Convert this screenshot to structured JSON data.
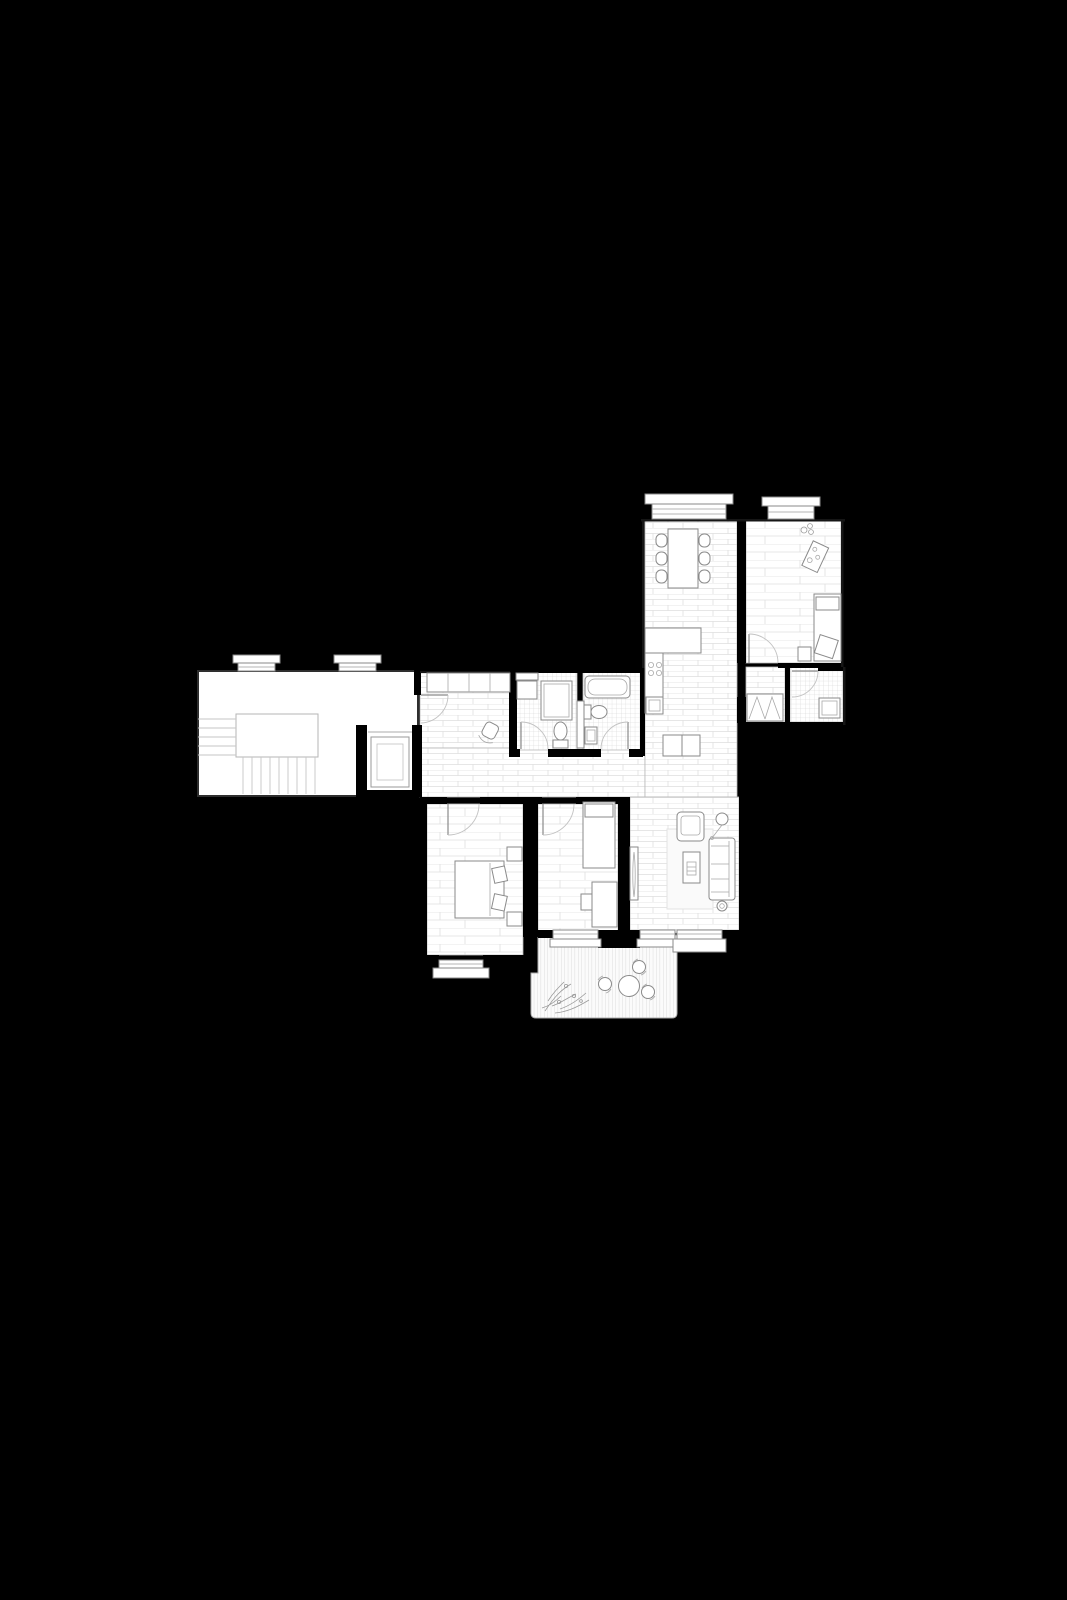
{
  "document": {
    "kind": "architectural floor plan",
    "orientation": "top-down",
    "visible_text": "none",
    "colors": {
      "background": "#000000",
      "floor_paper": "#ffffff",
      "interior_walls": "#000000",
      "furniture_line": "#8a8a8a",
      "floor_hatch_line": "#dcdcdc",
      "rug_fill": "#fafafa"
    }
  },
  "plan": {
    "rooms": [
      {
        "id": "stairwell",
        "name": "stairwell landing",
        "floor": "plain",
        "features": [
          "winder-staircase",
          "landing-void",
          "elevator-shaft"
        ],
        "windows": 2
      },
      {
        "id": "entry-hall",
        "name": "entry hall",
        "floor": "brick-tile",
        "furniture": [
          "built-in-wardrobe-4-sections",
          "stool"
        ]
      },
      {
        "id": "corridor",
        "name": "corridor",
        "floor": "brick-tile",
        "furniture": []
      },
      {
        "id": "bathroom-shower",
        "name": "shower bathroom",
        "floor": "fine-grid-tile",
        "furniture": [
          "washing-machine",
          "shelf",
          "shower-cabin",
          "toilet"
        ]
      },
      {
        "id": "bathroom-tub",
        "name": "bathtub bathroom",
        "floor": "fine-grid-tile",
        "furniture": [
          "bathtub",
          "toilet",
          "washbasin",
          "pocket-door"
        ]
      },
      {
        "id": "kitchen-dining",
        "name": "kitchen and dining room",
        "floor": "brick-tile",
        "furniture": [
          "dining-table",
          "six-chairs",
          "l-shaped-counter",
          "cooktop-4-burners",
          "oven",
          "base-units"
        ],
        "windows": 1
      },
      {
        "id": "bedroom-ne",
        "name": "north-east bedroom",
        "floor": "wood-plank",
        "furniture": [
          "single-bed",
          "pillow",
          "throw-blanket",
          "nightstand",
          "side-tray",
          "potted-plant"
        ],
        "windows": 1
      },
      {
        "id": "inner-hall-ne",
        "name": "inner hall",
        "floor": "brick-tile",
        "furniture": [
          "folding-door-closet"
        ]
      },
      {
        "id": "bathroom-utility",
        "name": "utility bathroom",
        "floor": "fine-grid-tile",
        "furniture": [
          "washing-machine"
        ]
      },
      {
        "id": "bedroom-sw",
        "name": "south-west bedroom",
        "floor": "wood-plank",
        "furniture": [
          "double-bed",
          "two-pillows",
          "nightstand-top",
          "nightstand-bottom"
        ],
        "windows": 1
      },
      {
        "id": "bedroom-s",
        "name": "south bedroom",
        "floor": "wood-plank",
        "furniture": [
          "single-bed",
          "pillow",
          "desk",
          "desk-chair"
        ],
        "windows": 1
      },
      {
        "id": "living-room",
        "name": "living room",
        "floor": "brick-tile",
        "furniture": [
          "rug",
          "armchair",
          "coffee-table",
          "three-seat-sofa",
          "floor-lamp",
          "round-side-table",
          "tv-unit"
        ],
        "windows": 2
      },
      {
        "id": "terrace",
        "name": "terrace",
        "floor": "vertical-deck-boards",
        "furniture": [
          "round-table",
          "three-round-chairs",
          "climbing-plant"
        ]
      }
    ],
    "openings": {
      "swing_doors": [
        "entry-door",
        "bathroom-shower-door",
        "bathroom-tub-door",
        "bedroom-sw-door",
        "bedroom-s-door",
        "bedroom-ne-door",
        "bathroom-utility-door"
      ],
      "sliding_or_pocket_doors": 1,
      "folding_closet_doors": 1,
      "glazed_openings_total": 8,
      "terrace_glazed_doors": 2
    },
    "counts": {
      "rooms": 13,
      "bathrooms": 3,
      "bedrooms": 3,
      "elevator": 1
    }
  }
}
